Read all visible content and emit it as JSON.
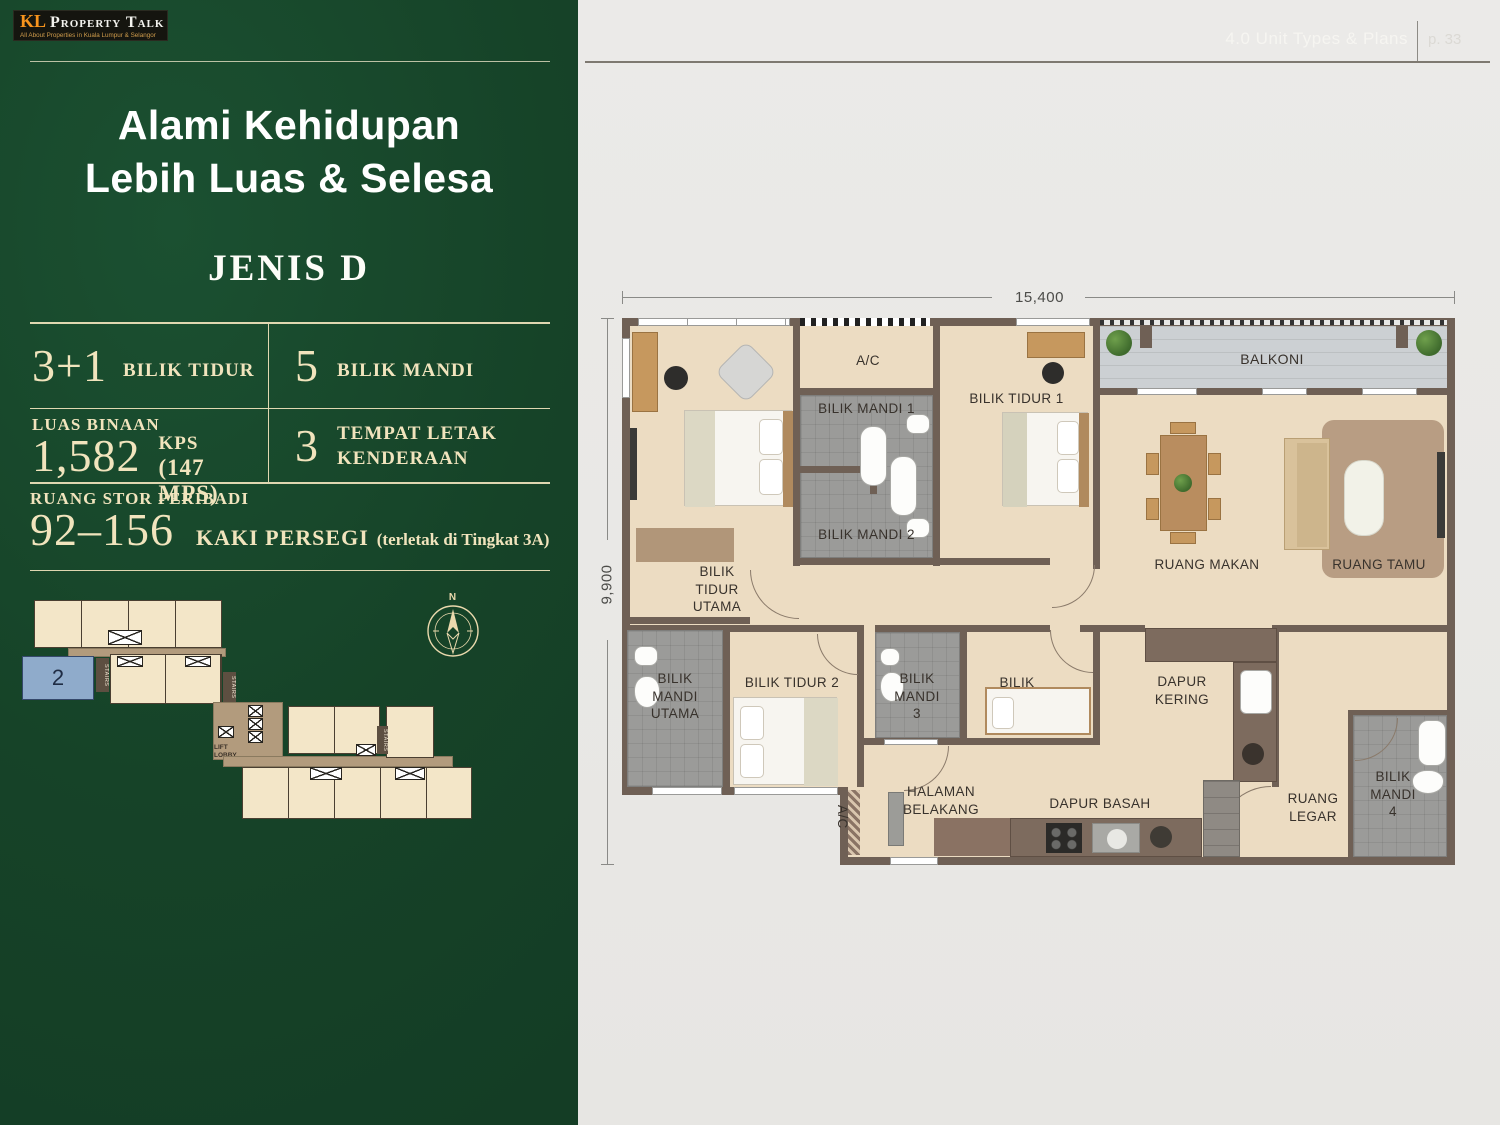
{
  "brand": {
    "kl": "KL",
    "title": "Property Talk",
    "subtitle": "All About Properties in Kuala Lumpur & Selangor"
  },
  "page_header": {
    "section": "4.0 Unit Types & Plans",
    "page": "p. 33"
  },
  "left_panel": {
    "headline_line1": "Alami Kehidupan",
    "headline_line2": "Lebih Luas & Selesa",
    "unit_type": "JENIS D",
    "specs": {
      "bedrooms_value": "3+1",
      "bedrooms_label": "BILIK TIDUR",
      "bathrooms_value": "5",
      "bathrooms_label": "BILIK MANDI",
      "built_up_label": "LUAS BINAAN",
      "built_up_value": "1,582",
      "built_up_unit": "KPS",
      "built_up_metric": "(147 MPS)",
      "parking_value": "3",
      "parking_label": "TEMPAT LETAK\nKENDERAAN",
      "storage_label": "RUANG STOR PERIBADI",
      "storage_value": "92–156",
      "storage_unit": "KAKI PERSEGI",
      "storage_note": "(terletak di Tingkat 3A)"
    },
    "site_plan": {
      "highlighted_unit": "2",
      "stairs": "STAIRS",
      "lift_lobby": "LIFT\nLOBBY",
      "compass": "N"
    }
  },
  "floor_plan": {
    "dim_width": "15,400",
    "dim_height": "9,900",
    "rooms": {
      "balkoni": "BALKONI",
      "ac_top": "A/C",
      "bilik_mandi_1": "BILIK MANDI 1",
      "bilik_mandi_2": "BILIK MANDI 2",
      "bilik_tidur_1": "BILIK TIDUR 1",
      "ruang_makan": "RUANG MAKAN",
      "ruang_tamu": "RUANG TAMU",
      "bilik_tidur_utama": "BILIK\nTIDUR\nUTAMA",
      "bilik_mandi_utama": "BILIK\nMANDI\nUTAMA",
      "bilik_tidur_2": "BILIK TIDUR 2",
      "bilik_mandi_3": "BILIK\nMANDI\n3",
      "bilik": "BILIK",
      "dapur_kering": "DAPUR\nKERING",
      "halaman_belakang": "HALAMAN\nBELAKANG",
      "dapur_basah": "DAPUR BASAH",
      "ruang_legar": "RUANG\nLEGAR",
      "bilik_mandi_4": "BILIK\nMANDI\n4",
      "ac_bottom": "A/C"
    }
  },
  "palette": {
    "panel_green": "#17432A",
    "accent_cream": "#F1E4BD",
    "wall_brown": "#6F6055",
    "bathroom_gray": "#9B9B99",
    "floor_beige": "#ECDCC2",
    "highlight_blue": "#8FABCB",
    "logo_orange": "#F7941D"
  }
}
